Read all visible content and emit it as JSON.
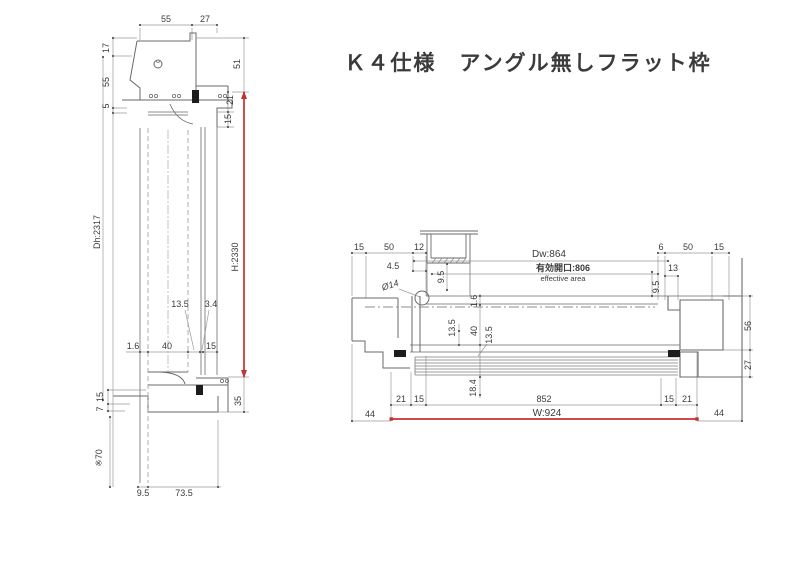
{
  "title": "Ｋ４仕様　アングル無しフラット枠",
  "colors": {
    "accent_red": "#c43131",
    "line_gray": "#8d8d8d",
    "profile_gray": "#6a6a6a"
  },
  "vertical_section": {
    "top_width_a": "55",
    "top_width_b": "27",
    "left_h_a": "17",
    "left_h_b": "55",
    "left_h_c": "5",
    "right_h_a": "51",
    "right_h_b": "21",
    "right_h_c": "15",
    "door_height": "Dh:2317",
    "frame_height": "H:2330",
    "mid_a": "13.5",
    "mid_b": "3.4",
    "mid_c": "1.6",
    "mid_d": "40",
    "mid_e": "15",
    "sill_a": "15",
    "sill_b": "7",
    "sill_c": "35",
    "below_floor": "※70",
    "bottom_a": "9.5",
    "bottom_b": "73.5"
  },
  "plan_section": {
    "top_l_a": "15",
    "top_l_b": "50",
    "top_l_c": "12",
    "top_l_d": "4.5",
    "hinge_dia": "Ø14",
    "box_depth_l": "9.5",
    "door_width": "Dw:864",
    "effective_opening": "有効開口:806",
    "effective_area_en": "effective area",
    "top_r_a": "6",
    "top_r_b": "50",
    "top_r_c": "15",
    "top_r_d": "13",
    "box_depth_r": "9.5",
    "right_a": "56",
    "right_b": "27",
    "mid_a": "1.6",
    "mid_b": "13.5",
    "mid_c": "40",
    "mid_d": "13.5",
    "mid_e": "18.4",
    "bot_a": "21",
    "bot_b": "15",
    "bot_c": "852",
    "bot_d": "15",
    "bot_e": "21",
    "bot_f": "44",
    "bot_g": "44",
    "frame_width": "W:924"
  }
}
